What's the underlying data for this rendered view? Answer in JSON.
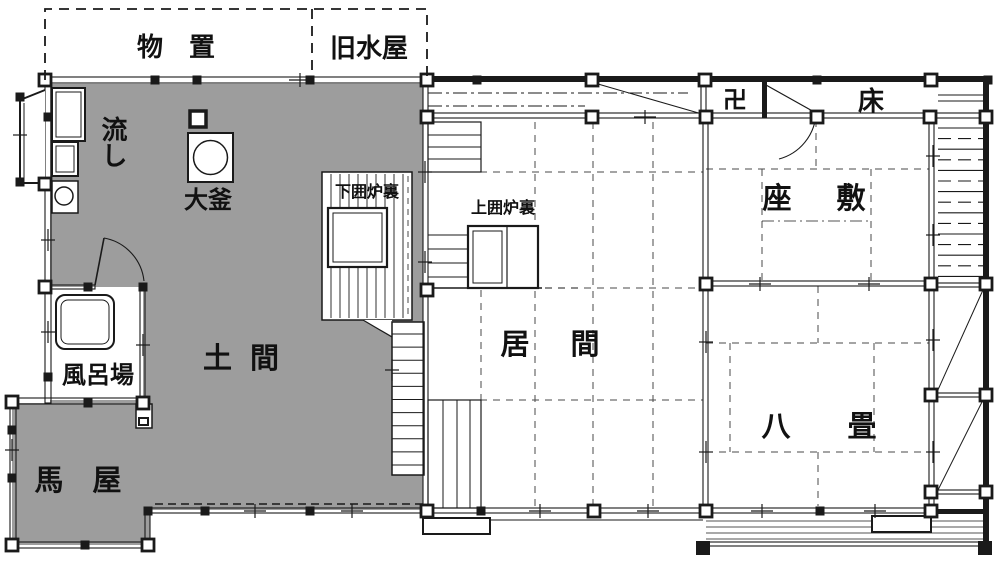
{
  "title": "伝統民家 平面図",
  "colors": {
    "doma_fill": "#9d9d9d",
    "line": "#1a1a1a",
    "background": "#ffffff",
    "tatami_dash": "#4a4a4a"
  },
  "rooms": {
    "monooki": "物　置",
    "kyu_mizuya": "旧水屋",
    "nagashi": "流し",
    "ogama": "大釜",
    "shimo_irori": "下囲炉裏",
    "kami_irori": "上囲炉裏",
    "manji": "卍",
    "toko": "床",
    "zashiki": "座　敷",
    "ima": "居　間",
    "hachijo": "八　畳",
    "doma": "土 間",
    "furoba": "風呂場",
    "umaya": "馬　屋"
  }
}
